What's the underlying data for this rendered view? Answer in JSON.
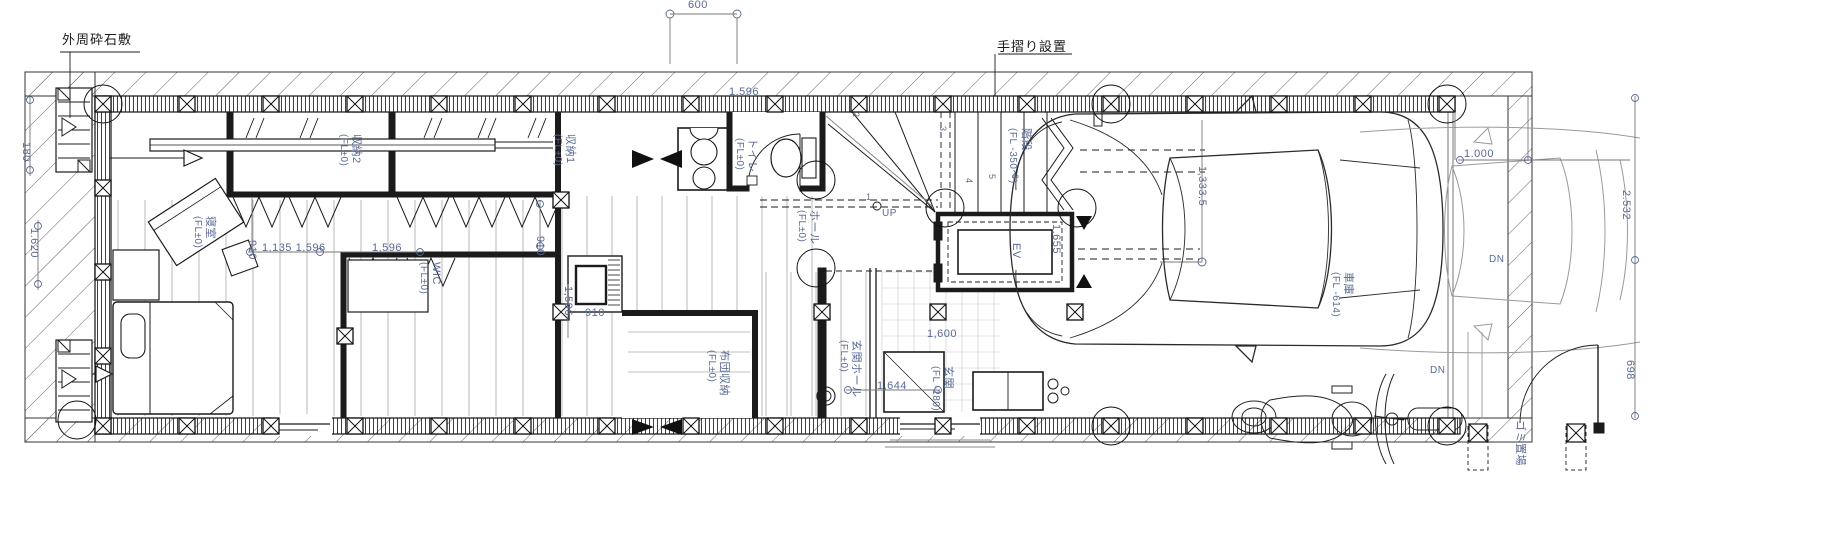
{
  "plan": {
    "colors": {
      "dim": "#5a6a94",
      "ink": "#1b1b1b"
    },
    "annotations": {
      "site_gravel": "外周砕石敷",
      "handrail": "手摺り設置"
    },
    "labels": [
      {
        "n": "dim-canopy-600",
        "t": "600",
        "x": 688,
        "y": 0,
        "o": "h",
        "c": "dim",
        "s": 11
      },
      {
        "n": "dim-top-1596",
        "t": "1,596",
        "x": 729,
        "y": 87,
        "o": "h",
        "c": "dim",
        "s": 11
      },
      {
        "n": "room-shinshitsu",
        "t": "寝室",
        "x": 215,
        "y": 216,
        "o": "v",
        "c": "dim",
        "s": 11
      },
      {
        "n": "room-shinshitsu-level",
        "t": "(FL±0)",
        "x": 202,
        "y": 216,
        "o": "v",
        "c": "dim",
        "s": 10
      },
      {
        "n": "room-shuno2",
        "t": "収納2",
        "x": 361,
        "y": 134,
        "o": "v",
        "c": "dim",
        "s": 11
      },
      {
        "n": "room-shuno2-level",
        "t": "(FL±0)",
        "x": 348,
        "y": 134,
        "o": "v",
        "c": "dim",
        "s": 10
      },
      {
        "n": "room-shuno1",
        "t": "収納1",
        "x": 575,
        "y": 134,
        "o": "v",
        "c": "dim",
        "s": 11
      },
      {
        "n": "room-shuno1-level",
        "t": "(FL±0)",
        "x": 562,
        "y": 134,
        "o": "v",
        "c": "dim",
        "s": 10
      },
      {
        "n": "room-toilet",
        "t": "トイレ",
        "x": 757,
        "y": 138,
        "o": "v",
        "c": "dim",
        "s": 11
      },
      {
        "n": "room-toilet-level",
        "t": "(FL±0)",
        "x": 744,
        "y": 138,
        "o": "v",
        "c": "dim",
        "s": 10
      },
      {
        "n": "room-hall",
        "t": "ホール",
        "x": 819,
        "y": 210,
        "o": "v",
        "c": "dim",
        "s": 11
      },
      {
        "n": "room-hall-level",
        "t": "(FL±0)",
        "x": 806,
        "y": 210,
        "o": "v",
        "c": "dim",
        "s": 10
      },
      {
        "n": "room-wic",
        "t": "WIC",
        "x": 441,
        "y": 262,
        "o": "v",
        "c": "dim",
        "s": 11
      },
      {
        "n": "room-wic-level",
        "t": "(FL±0)",
        "x": 428,
        "y": 262,
        "o": "v",
        "c": "dim",
        "s": 10
      },
      {
        "n": "room-futon",
        "t": "布団収納",
        "x": 729,
        "y": 350,
        "o": "v",
        "c": "dim",
        "s": 11
      },
      {
        "n": "room-futon-level",
        "t": "(FL±0)",
        "x": 716,
        "y": 350,
        "o": "v",
        "c": "dim",
        "s": 10
      },
      {
        "n": "room-genkan-hall",
        "t": "玄関ホール",
        "x": 861,
        "y": 340,
        "o": "v",
        "c": "dim",
        "s": 11
      },
      {
        "n": "room-genkan-hall-level",
        "t": "(FL±0)",
        "x": 848,
        "y": 340,
        "o": "v",
        "c": "dim",
        "s": 10
      },
      {
        "n": "room-genkan",
        "t": "玄関",
        "x": 953,
        "y": 366,
        "o": "v",
        "c": "dim",
        "s": 11
      },
      {
        "n": "room-genkan-level",
        "t": "(FL -180)",
        "x": 940,
        "y": 366,
        "o": "v",
        "c": "dim",
        "s": 10
      },
      {
        "n": "room-stairs",
        "t": "階段",
        "x": 1031,
        "y": 128,
        "o": "v",
        "c": "dim",
        "s": 11
      },
      {
        "n": "room-stairs-level",
        "t": "(FL -350〜)",
        "x": 1017,
        "y": 128,
        "o": "v",
        "c": "dim",
        "s": 10
      },
      {
        "n": "room-ev",
        "t": "EV",
        "x": 1021,
        "y": 243,
        "o": "v",
        "c": "dim",
        "s": 11
      },
      {
        "n": "room-garage",
        "t": "車庫",
        "x": 1353,
        "y": 272,
        "o": "v",
        "c": "dim",
        "s": 11
      },
      {
        "n": "room-garage-level",
        "t": "(FL -614)",
        "x": 1340,
        "y": 272,
        "o": "v",
        "c": "dim",
        "s": 10
      },
      {
        "n": "room-gomi",
        "t": "ゴミ置場",
        "x": 1525,
        "y": 420,
        "o": "v",
        "c": "dim",
        "s": 11
      },
      {
        "n": "dim-1135-1596",
        "t": "1,135 1,596",
        "x": 262,
        "y": 243,
        "o": "h",
        "c": "dim",
        "s": 11
      },
      {
        "n": "dim-1596-b",
        "t": "1,596",
        "x": 372,
        "y": 243,
        "o": "h",
        "c": "dim",
        "s": 11
      },
      {
        "n": "dim-910-a",
        "t": "910",
        "x": 257,
        "y": 240,
        "o": "v",
        "c": "dim",
        "s": 11
      },
      {
        "n": "dim-910-b",
        "t": "910",
        "x": 545,
        "y": 236,
        "o": "v",
        "c": "dim",
        "s": 11
      },
      {
        "n": "dim-910-c",
        "t": "910",
        "x": 585,
        "y": 308,
        "o": "h",
        "c": "dim",
        "s": 11
      },
      {
        "n": "dim-1596-v",
        "t": "1,596",
        "x": 573,
        "y": 286,
        "o": "v",
        "c": "dim",
        "s": 11
      },
      {
        "n": "dim-1644",
        "t": "1,644",
        "x": 877,
        "y": 381,
        "o": "h",
        "c": "dim",
        "s": 11
      },
      {
        "n": "dim-1600",
        "t": "1,600",
        "x": 927,
        "y": 329,
        "o": "h",
        "c": "dim",
        "s": 11
      },
      {
        "n": "dim-1655",
        "t": "1,655",
        "x": 1061,
        "y": 224,
        "o": "v",
        "c": "dim",
        "s": 11
      },
      {
        "n": "dim-1333",
        "t": "1,333.5",
        "x": 1207,
        "y": 166,
        "o": "v",
        "c": "dim",
        "s": 11
      },
      {
        "n": "dim-1000",
        "t": "1.000",
        "x": 1464,
        "y": 149,
        "o": "h",
        "c": "dim",
        "s": 11
      },
      {
        "n": "dim-2532",
        "t": "2.532",
        "x": 1631,
        "y": 190,
        "o": "v",
        "c": "dim",
        "s": 11
      },
      {
        "n": "dim-698",
        "t": "698",
        "x": 1635,
        "y": 360,
        "o": "v",
        "c": "dim",
        "s": 11
      },
      {
        "n": "dim-180",
        "t": "180",
        "x": 31,
        "y": 142,
        "o": "v",
        "c": "dim",
        "s": 11
      },
      {
        "n": "dim-1620",
        "t": "1.620",
        "x": 39,
        "y": 228,
        "o": "v",
        "c": "dim",
        "s": 11
      },
      {
        "n": "label-up",
        "t": "UP",
        "x": 882,
        "y": 209,
        "o": "h",
        "c": "dim",
        "s": 10
      },
      {
        "n": "label-dn-1",
        "t": "DN",
        "x": 1489,
        "y": 255,
        "o": "h",
        "c": "dim",
        "s": 10
      },
      {
        "n": "label-dn-2",
        "t": "DN",
        "x": 1430,
        "y": 366,
        "o": "h",
        "c": "dim",
        "s": 10
      },
      {
        "n": "stair-step-1",
        "t": "1",
        "x": 866,
        "y": 193,
        "o": "h",
        "c": "dim",
        "s": 9
      },
      {
        "n": "stair-step-2",
        "t": "2",
        "x": 860,
        "y": 112,
        "o": "v",
        "c": "dim",
        "s": 9
      },
      {
        "n": "stair-step-3",
        "t": "3",
        "x": 947,
        "y": 126,
        "o": "v",
        "c": "dim",
        "s": 9
      },
      {
        "n": "stair-step-4",
        "t": "4",
        "x": 973,
        "y": 178,
        "o": "v",
        "c": "dim",
        "s": 9
      },
      {
        "n": "stair-step-5",
        "t": "5",
        "x": 996,
        "y": 174,
        "o": "v",
        "c": "dim",
        "s": 9
      },
      {
        "n": "stair-step-6",
        "t": "6",
        "x": 1019,
        "y": 174,
        "o": "v",
        "c": "dim",
        "s": 9
      }
    ]
  }
}
